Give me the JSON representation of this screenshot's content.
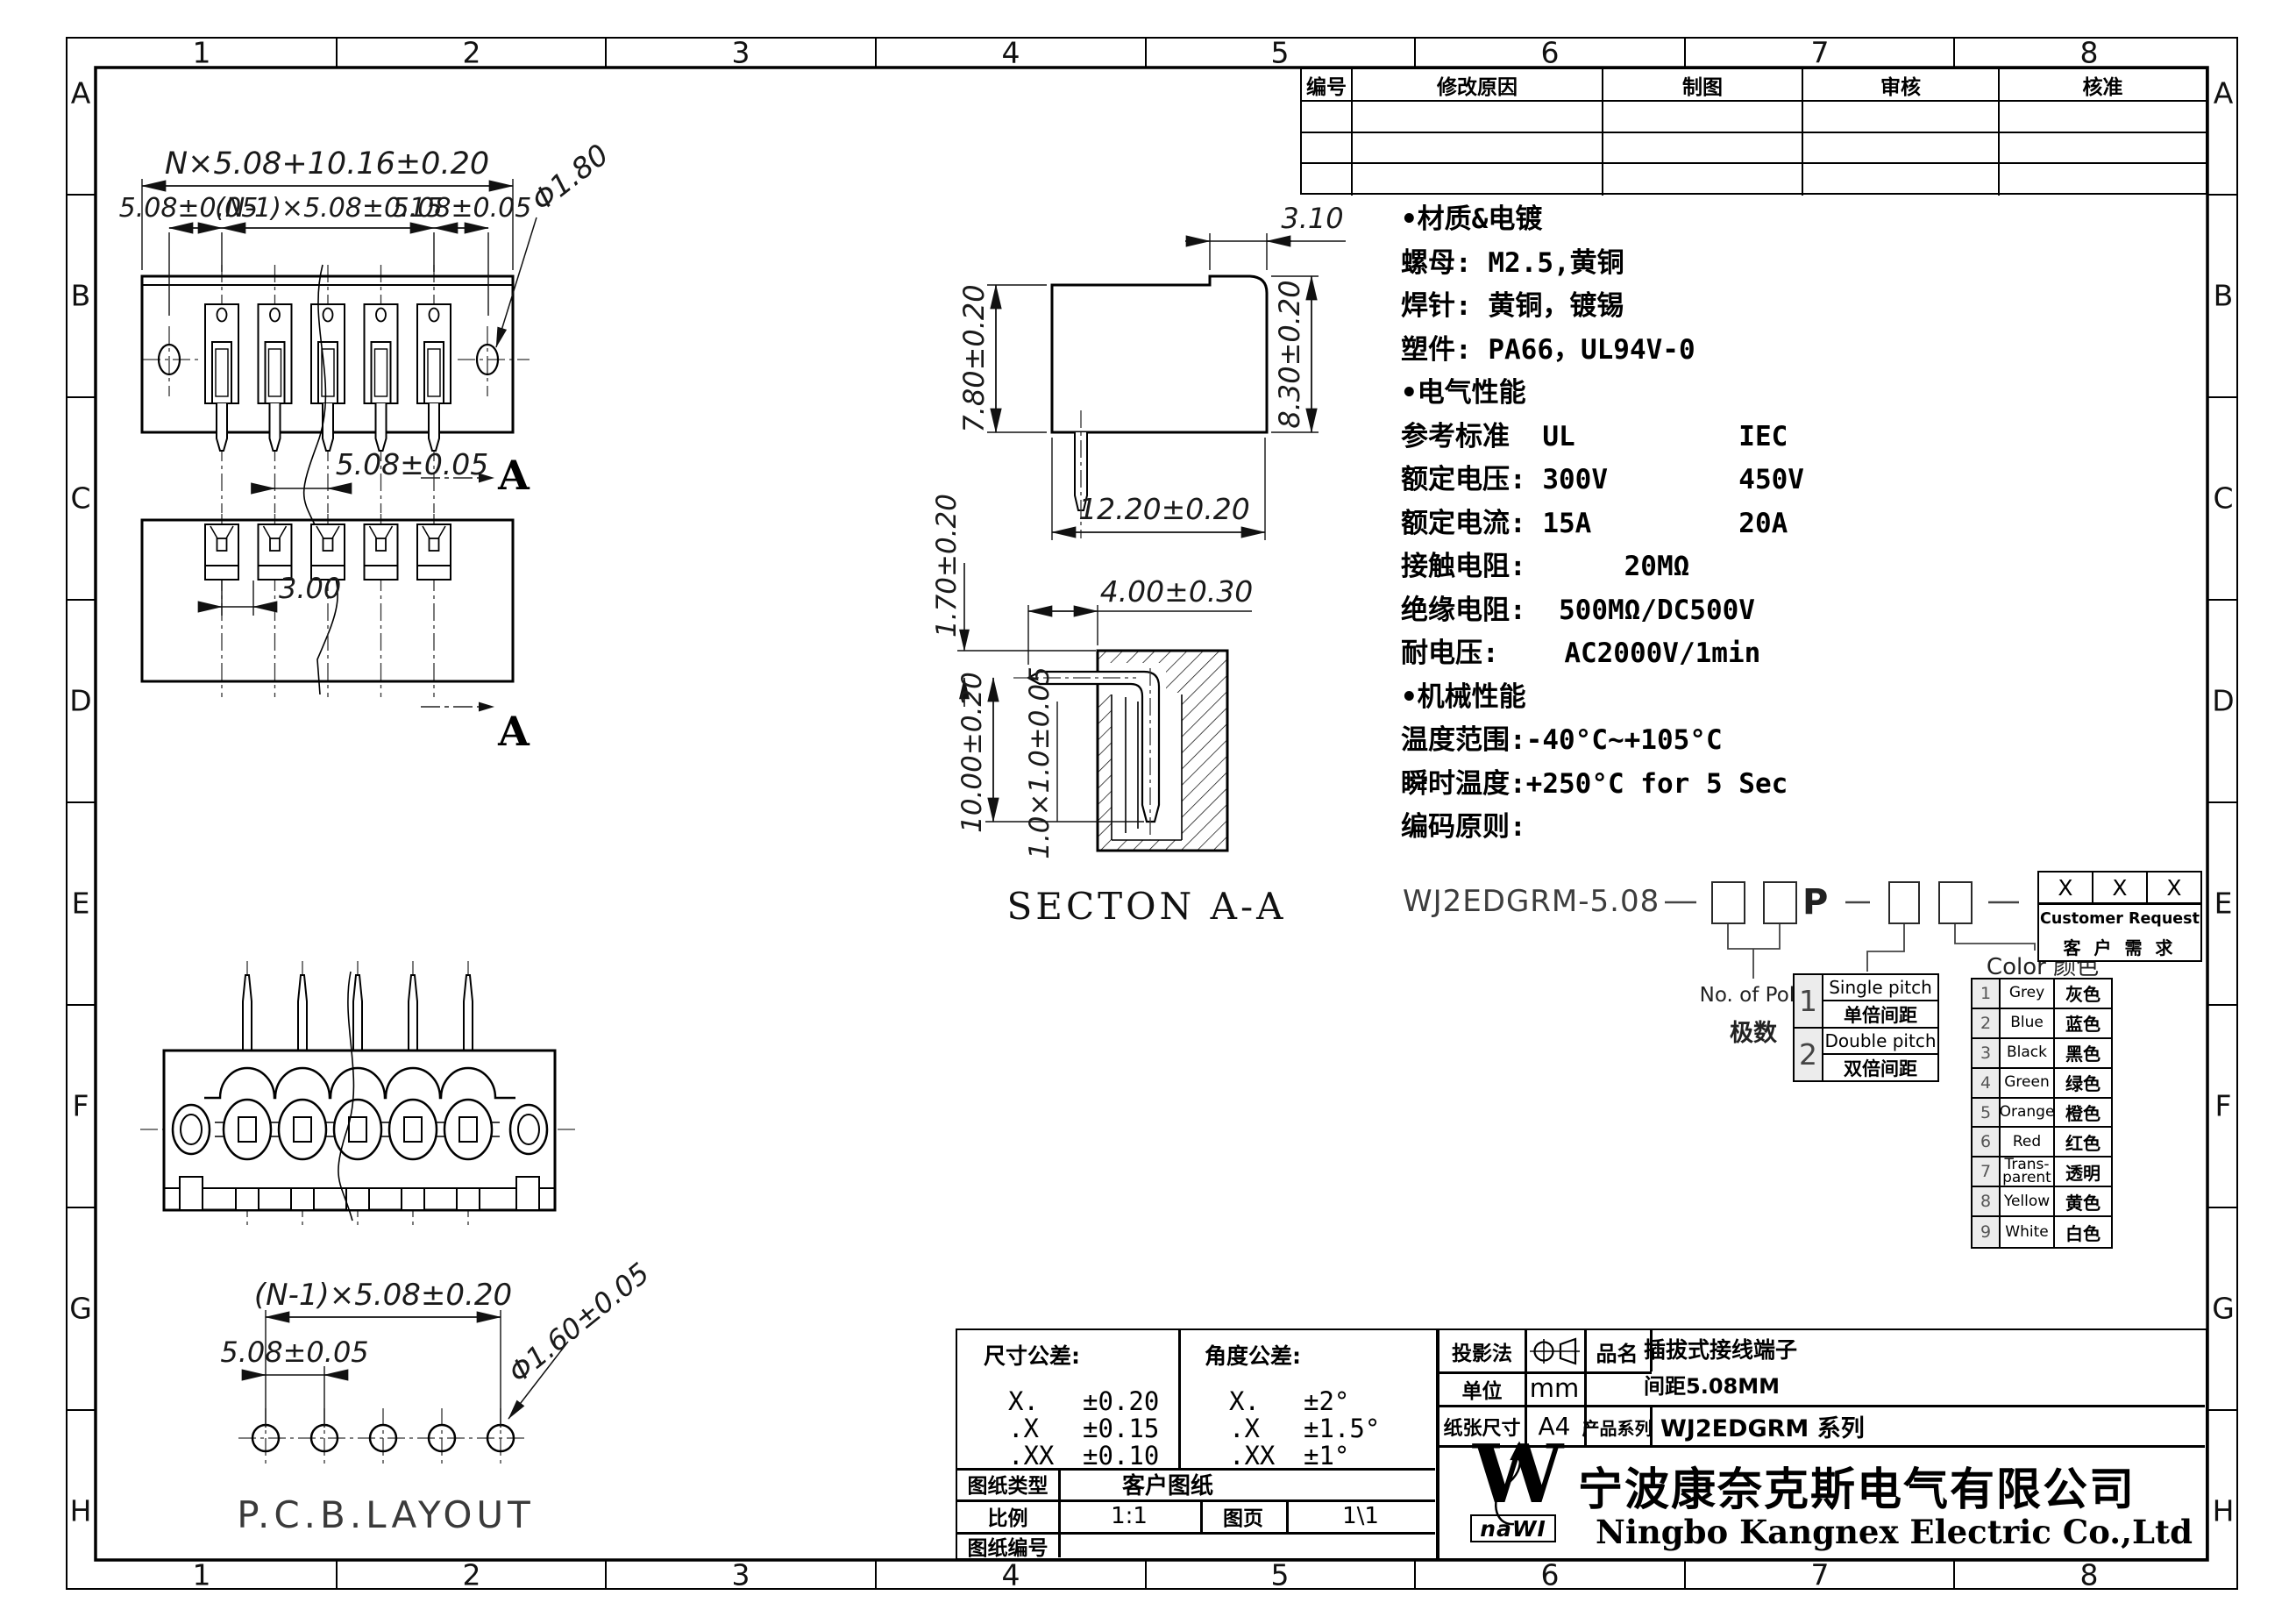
{
  "frame": {
    "cols": [
      "1",
      "2",
      "3",
      "4",
      "5",
      "6",
      "7",
      "8"
    ],
    "rows": [
      "A",
      "B",
      "C",
      "D",
      "E",
      "F",
      "G",
      "H"
    ]
  },
  "revision": {
    "headers": [
      "编号",
      "修改原因",
      "制图",
      "审核",
      "核准"
    ]
  },
  "specs": {
    "lines": [
      "•材质&电镀",
      "螺母: M2.5,黄铜",
      "焊针: 黄铜，镀锡",
      "塑件: PA66，UL94V-0",
      "•电气性能",
      "参考标准  UL          IEC",
      "额定电压: 300V        450V",
      "额定电流: 15A         20A",
      "接触电阻:      20MΩ",
      "绝缘电阻:  500MΩ/DC500V",
      "耐电压:    AC2000V/1min",
      "•机械性能",
      "温度范围:-40°C~+105°C",
      "瞬时温度:+250°C for 5 Sec",
      "编码原则:"
    ]
  },
  "coding": {
    "part_prefix": "WJ2EDGRM-5.08",
    "p": "P",
    "pole_en": "No. of Pole",
    "pole_cn": "极数",
    "pitch_rows": [
      {
        "n": "1",
        "en": "Single pitch",
        "cn": "单倍间距"
      },
      {
        "n": "2",
        "en": "Double pitch",
        "cn": "双倍间距"
      }
    ],
    "color_title": "Color 颜色",
    "colors": [
      {
        "n": "1",
        "en": "Grey",
        "cn": "灰色"
      },
      {
        "n": "2",
        "en": "Blue",
        "cn": "蓝色"
      },
      {
        "n": "3",
        "en": "Black",
        "cn": "黑色"
      },
      {
        "n": "4",
        "en": "Green",
        "cn": "绿色"
      },
      {
        "n": "5",
        "en": "Orange",
        "cn": "橙色"
      },
      {
        "n": "6",
        "en": "Red",
        "cn": "红色"
      },
      {
        "n": "7",
        "en": "Trans- parent",
        "cn": "透明"
      },
      {
        "n": "8",
        "en": "Yellow",
        "cn": "黄色"
      },
      {
        "n": "9",
        "en": "White",
        "cn": "白色"
      }
    ],
    "customer_x": [
      "X",
      "X",
      "X"
    ],
    "customer_en": "Customer Request",
    "customer_cn": "客 户 需 求"
  },
  "dims": {
    "total": "N×5.08+10.16±0.20",
    "pitch_left": "5.08±0.05",
    "pitch_mid": "(N-1)×5.08±0.15",
    "pitch_right": "5.08±0.05",
    "hole_dia": "Φ1.80",
    "pitch_single": "5.08±0.05",
    "dim_3": "3.00",
    "dim_310": "3.10",
    "h780": "7.80±0.20",
    "h830": "8.30±0.20",
    "w1220": "12.20±0.20",
    "d170": "1.70±0.20",
    "d400": "4.00±0.30",
    "d1000": "10.00±0.20",
    "pin_sq": "1.0×1.0±0.05",
    "pcb_total": "(N-1)×5.08±0.20",
    "pcb_pitch": "5.08±0.05",
    "pcb_hole": "Φ1.60±0.05"
  },
  "views": {
    "section_marker": "A",
    "section_title": "SECTON  A-A",
    "pcb_title": "P.C.B.LAYOUT"
  },
  "tolerance": {
    "dim_title": "尺寸公差:",
    "ang_title": "角度公差:",
    "dim_rows": [
      {
        "k": "X.",
        "v": "±0.20"
      },
      {
        "k": ".X",
        "v": "±0.15"
      },
      {
        "k": ".XX",
        "v": "±0.10"
      }
    ],
    "ang_rows": [
      {
        "k": "X.",
        "v": "±2°"
      },
      {
        "k": ".X",
        "v": "±1.5°"
      },
      {
        "k": ".XX",
        "v": "±1°"
      }
    ],
    "doc_type_label": "图纸类型",
    "doc_type_value": "客户图纸",
    "scale_label": "比例",
    "scale_value": "1:1",
    "page_label": "图页",
    "page_value": "1\\1",
    "doc_no_label": "图纸编号",
    "doc_no_value": ""
  },
  "titleblock": {
    "projection_label": "投影法",
    "name_label": "品名",
    "name_line1": "插拔式接线端子",
    "name_line2": "间距5.08MM",
    "unit_label": "单位",
    "unit_value": "mm",
    "paper_label": "纸张尺寸",
    "paper_value": "A4",
    "series_label": "产品系列",
    "series_value": "WJ2EDGRM 系列"
  },
  "company": {
    "logo_w": "W",
    "logo_text": "naWI",
    "cn": "宁波康奈克斯电气有限公司",
    "en": "Ningbo Kangnex Electric Co.,Ltd"
  }
}
